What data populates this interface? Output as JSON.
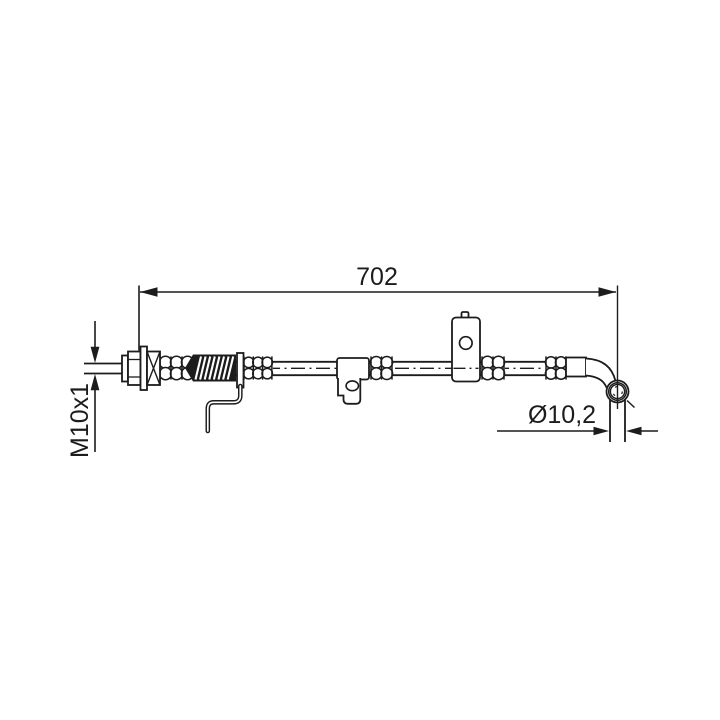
{
  "drawing": {
    "type": "technical-drawing-brake-hose",
    "background_color": "#ffffff",
    "line_color": "#1c1c1c",
    "dimensions": {
      "length": "702",
      "thread": "M10x1",
      "diameter": "Ø10,2"
    }
  }
}
